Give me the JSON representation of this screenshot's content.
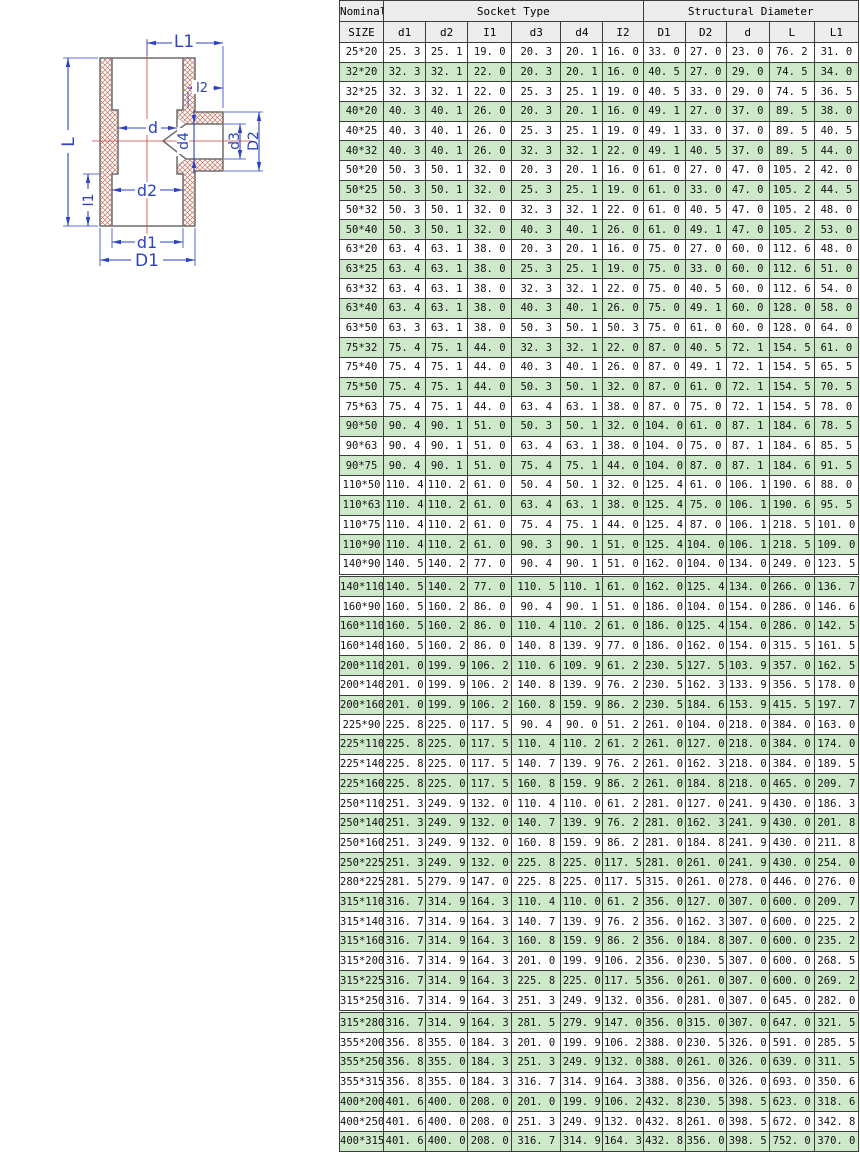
{
  "colors": {
    "dim-blue": "#2e43c1",
    "centerline-red": "#cc4444",
    "hatch-red": "#c4705c",
    "row-green": "#cde9c9",
    "header-gray": "#ededed",
    "grid-border": "#3c3c3c"
  },
  "diagram": {
    "labels": {
      "L1": "L1",
      "I2": "I2",
      "d": "d",
      "d4": "d4",
      "d3": "d3",
      "D2": "D2",
      "L": "L",
      "I1": "I1",
      "d2": "d2",
      "d1": "d1",
      "D1": "D1"
    }
  },
  "table": {
    "header": {
      "nominal": "Nominal",
      "size": "SIZE",
      "socket_group": "Socket Type",
      "structural_group": "Structural Diameter",
      "socket_columns": [
        "d1",
        "d2",
        "I1",
        "d3",
        "d4",
        "I2"
      ],
      "structural_columns": [
        "D1",
        "D2",
        "d",
        "L",
        "L1"
      ]
    },
    "section_break_rows": [
      27,
      49
    ],
    "rows": [
      [
        "25*20",
        "25.3",
        "25.1",
        "19.0",
        "20.3",
        "20.1",
        "16.0",
        "33.0",
        "27.0",
        "23.0",
        "76.2",
        "31.0"
      ],
      [
        "32*20",
        "32.3",
        "32.1",
        "22.0",
        "20.3",
        "20.1",
        "16.0",
        "40.5",
        "27.0",
        "29.0",
        "74.5",
        "34.0"
      ],
      [
        "32*25",
        "32.3",
        "32.1",
        "22.0",
        "25.3",
        "25.1",
        "19.0",
        "40.5",
        "33.0",
        "29.0",
        "74.5",
        "36.5"
      ],
      [
        "40*20",
        "40.3",
        "40.1",
        "26.0",
        "20.3",
        "20.1",
        "16.0",
        "49.1",
        "27.0",
        "37.0",
        "89.5",
        "38.0"
      ],
      [
        "40*25",
        "40.3",
        "40.1",
        "26.0",
        "25.3",
        "25.1",
        "19.0",
        "49.1",
        "33.0",
        "37.0",
        "89.5",
        "40.5"
      ],
      [
        "40*32",
        "40.3",
        "40.1",
        "26.0",
        "32.3",
        "32.1",
        "22.0",
        "49.1",
        "40.5",
        "37.0",
        "89.5",
        "44.0"
      ],
      [
        "50*20",
        "50.3",
        "50.1",
        "32.0",
        "20.3",
        "20.1",
        "16.0",
        "61.0",
        "27.0",
        "47.0",
        "105.2",
        "42.0"
      ],
      [
        "50*25",
        "50.3",
        "50.1",
        "32.0",
        "25.3",
        "25.1",
        "19.0",
        "61.0",
        "33.0",
        "47.0",
        "105.2",
        "44.5"
      ],
      [
        "50*32",
        "50.3",
        "50.1",
        "32.0",
        "32.3",
        "32.1",
        "22.0",
        "61.0",
        "40.5",
        "47.0",
        "105.2",
        "48.0"
      ],
      [
        "50*40",
        "50.3",
        "50.1",
        "32.0",
        "40.3",
        "40.1",
        "26.0",
        "61.0",
        "49.1",
        "47.0",
        "105.2",
        "53.0"
      ],
      [
        "63*20",
        "63.4",
        "63.1",
        "38.0",
        "20.3",
        "20.1",
        "16.0",
        "75.0",
        "27.0",
        "60.0",
        "112.6",
        "48.0"
      ],
      [
        "63*25",
        "63.4",
        "63.1",
        "38.0",
        "25.3",
        "25.1",
        "19.0",
        "75.0",
        "33.0",
        "60.0",
        "112.6",
        "51.0"
      ],
      [
        "63*32",
        "63.4",
        "63.1",
        "38.0",
        "32.3",
        "32.1",
        "22.0",
        "75.0",
        "40.5",
        "60.0",
        "112.6",
        "54.0"
      ],
      [
        "63*40",
        "63.4",
        "63.1",
        "38.0",
        "40.3",
        "40.1",
        "26.0",
        "75.0",
        "49.1",
        "60.0",
        "128.0",
        "58.0"
      ],
      [
        "63*50",
        "63.3",
        "63.1",
        "38.0",
        "50.3",
        "50.1",
        "50.3",
        "75.0",
        "61.0",
        "60.0",
        "128.0",
        "64.0"
      ],
      [
        "75*32",
        "75.4",
        "75.1",
        "44.0",
        "32.3",
        "32.1",
        "22.0",
        "87.0",
        "40.5",
        "72.1",
        "154.5",
        "61.0"
      ],
      [
        "75*40",
        "75.4",
        "75.1",
        "44.0",
        "40.3",
        "40.1",
        "26.0",
        "87.0",
        "49.1",
        "72.1",
        "154.5",
        "65.5"
      ],
      [
        "75*50",
        "75.4",
        "75.1",
        "44.0",
        "50.3",
        "50.1",
        "32.0",
        "87.0",
        "61.0",
        "72.1",
        "154.5",
        "70.5"
      ],
      [
        "75*63",
        "75.4",
        "75.1",
        "44.0",
        "63.4",
        "63.1",
        "38.0",
        "87.0",
        "75.0",
        "72.1",
        "154.5",
        "78.0"
      ],
      [
        "90*50",
        "90.4",
        "90.1",
        "51.0",
        "50.3",
        "50.1",
        "32.0",
        "104.0",
        "61.0",
        "87.1",
        "184.6",
        "78.5"
      ],
      [
        "90*63",
        "90.4",
        "90.1",
        "51.0",
        "63.4",
        "63.1",
        "38.0",
        "104.0",
        "75.0",
        "87.1",
        "184.6",
        "85.5"
      ],
      [
        "90*75",
        "90.4",
        "90.1",
        "51.0",
        "75.4",
        "75.1",
        "44.0",
        "104.0",
        "87.0",
        "87.1",
        "184.6",
        "91.5"
      ],
      [
        "110*50",
        "110.4",
        "110.2",
        "61.0",
        "50.4",
        "50.1",
        "32.0",
        "125.4",
        "61.0",
        "106.1",
        "190.6",
        "88.0"
      ],
      [
        "110*63",
        "110.4",
        "110.2",
        "61.0",
        "63.4",
        "63.1",
        "38.0",
        "125.4",
        "75.0",
        "106.1",
        "190.6",
        "95.5"
      ],
      [
        "110*75",
        "110.4",
        "110.2",
        "61.0",
        "75.4",
        "75.1",
        "44.0",
        "125.4",
        "87.0",
        "106.1",
        "218.5",
        "101.0"
      ],
      [
        "110*90",
        "110.4",
        "110.2",
        "61.0",
        "90.3",
        "90.1",
        "51.0",
        "125.4",
        "104.0",
        "106.1",
        "218.5",
        "109.0"
      ],
      [
        "140*90",
        "140.5",
        "140.2",
        "77.0",
        "90.4",
        "90.1",
        "51.0",
        "162.0",
        "104.0",
        "134.0",
        "249.0",
        "123.5"
      ],
      [
        "140*110",
        "140.5",
        "140.2",
        "77.0",
        "110.5",
        "110.1",
        "61.0",
        "162.0",
        "125.4",
        "134.0",
        "266.0",
        "136.7"
      ],
      [
        "160*90",
        "160.5",
        "160.2",
        "86.0",
        "90.4",
        "90.1",
        "51.0",
        "186.0",
        "104.0",
        "154.0",
        "286.0",
        "146.6"
      ],
      [
        "160*110",
        "160.5",
        "160.2",
        "86.0",
        "110.4",
        "110.2",
        "61.0",
        "186.0",
        "125.4",
        "154.0",
        "286.0",
        "142.5"
      ],
      [
        "160*140",
        "160.5",
        "160.2",
        "86.0",
        "140.8",
        "139.9",
        "77.0",
        "186.0",
        "162.0",
        "154.0",
        "315.5",
        "161.5"
      ],
      [
        "200*110",
        "201.0",
        "199.9",
        "106.2",
        "110.6",
        "109.9",
        "61.2",
        "230.5",
        "127.5",
        "103.9",
        "357.0",
        "162.5"
      ],
      [
        "200*140",
        "201.0",
        "199.9",
        "106.2",
        "140.8",
        "139.9",
        "76.2",
        "230.5",
        "162.3",
        "133.9",
        "356.5",
        "178.0"
      ],
      [
        "200*160",
        "201.0",
        "199.9",
        "106.2",
        "160.8",
        "159.9",
        "86.2",
        "230.5",
        "184.6",
        "153.9",
        "415.5",
        "197.7"
      ],
      [
        "225*90",
        "225.8",
        "225.0",
        "117.5",
        "90.4",
        "90.0",
        "51.2",
        "261.0",
        "104.0",
        "218.0",
        "384.0",
        "163.0"
      ],
      [
        "225*110",
        "225.8",
        "225.0",
        "117.5",
        "110.4",
        "110.2",
        "61.2",
        "261.0",
        "127.0",
        "218.0",
        "384.0",
        "174.0"
      ],
      [
        "225*140",
        "225.8",
        "225.0",
        "117.5",
        "140.7",
        "139.9",
        "76.2",
        "261.0",
        "162.3",
        "218.0",
        "384.0",
        "189.5"
      ],
      [
        "225*160",
        "225.8",
        "225.0",
        "117.5",
        "160.8",
        "159.9",
        "86.2",
        "261.0",
        "184.8",
        "218.0",
        "465.0",
        "209.7"
      ],
      [
        "250*110",
        "251.3",
        "249.9",
        "132.0",
        "110.4",
        "110.0",
        "61.2",
        "281.0",
        "127.0",
        "241.9",
        "430.0",
        "186.3"
      ],
      [
        "250*140",
        "251.3",
        "249.9",
        "132.0",
        "140.7",
        "139.9",
        "76.2",
        "281.0",
        "162.3",
        "241.9",
        "430.0",
        "201.8"
      ],
      [
        "250*160",
        "251.3",
        "249.9",
        "132.0",
        "160.8",
        "159.9",
        "86.2",
        "281.0",
        "184.8",
        "241.9",
        "430.0",
        "211.8"
      ],
      [
        "250*225",
        "251.3",
        "249.9",
        "132.0",
        "225.8",
        "225.0",
        "117.5",
        "281.0",
        "261.0",
        "241.9",
        "430.0",
        "254.0"
      ],
      [
        "280*225",
        "281.5",
        "279.9",
        "147.0",
        "225.8",
        "225.0",
        "117.5",
        "315.0",
        "261.0",
        "278.0",
        "446.0",
        "276.0"
      ],
      [
        "315*110",
        "316.7",
        "314.9",
        "164.3",
        "110.4",
        "110.0",
        "61.2",
        "356.0",
        "127.0",
        "307.0",
        "600.0",
        "209.7"
      ],
      [
        "315*140",
        "316.7",
        "314.9",
        "164.3",
        "140.7",
        "139.9",
        "76.2",
        "356.0",
        "162.3",
        "307.0",
        "600.0",
        "225.2"
      ],
      [
        "315*160",
        "316.7",
        "314.9",
        "164.3",
        "160.8",
        "159.9",
        "86.2",
        "356.0",
        "184.8",
        "307.0",
        "600.0",
        "235.2"
      ],
      [
        "315*200",
        "316.7",
        "314.9",
        "164.3",
        "201.0",
        "199.9",
        "106.2",
        "356.0",
        "230.5",
        "307.0",
        "600.0",
        "268.5"
      ],
      [
        "315*225",
        "316.7",
        "314.9",
        "164.3",
        "225.8",
        "225.0",
        "117.5",
        "356.0",
        "261.0",
        "307.0",
        "600.0",
        "269.2"
      ],
      [
        "315*250",
        "316.7",
        "314.9",
        "164.3",
        "251.3",
        "249.9",
        "132.0",
        "356.0",
        "281.0",
        "307.0",
        "645.0",
        "282.0"
      ],
      [
        "315*280",
        "316.7",
        "314.9",
        "164.3",
        "281.5",
        "279.9",
        "147.0",
        "356.0",
        "315.0",
        "307.0",
        "647.0",
        "321.5"
      ],
      [
        "355*200",
        "356.8",
        "355.0",
        "184.3",
        "201.0",
        "199.9",
        "106.2",
        "388.0",
        "230.5",
        "326.0",
        "591.0",
        "285.5"
      ],
      [
        "355*250",
        "356.8",
        "355.0",
        "184.3",
        "251.3",
        "249.9",
        "132.0",
        "388.0",
        "261.0",
        "326.0",
        "639.0",
        "311.5"
      ],
      [
        "355*315",
        "356.8",
        "355.0",
        "184.3",
        "316.7",
        "314.9",
        "164.3",
        "388.0",
        "356.0",
        "326.0",
        "693.0",
        "350.6"
      ],
      [
        "400*200",
        "401.6",
        "400.0",
        "208.0",
        "201.0",
        "199.9",
        "106.2",
        "432.8",
        "230.5",
        "398.5",
        "623.0",
        "318.6"
      ],
      [
        "400*250",
        "401.6",
        "400.0",
        "208.0",
        "251.3",
        "249.9",
        "132.0",
        "432.8",
        "261.0",
        "398.5",
        "672.0",
        "342.8"
      ],
      [
        "400*315",
        "401.6",
        "400.0",
        "208.0",
        "316.7",
        "314.9",
        "164.3",
        "432.8",
        "356.0",
        "398.5",
        "752.0",
        "370.0"
      ]
    ]
  }
}
